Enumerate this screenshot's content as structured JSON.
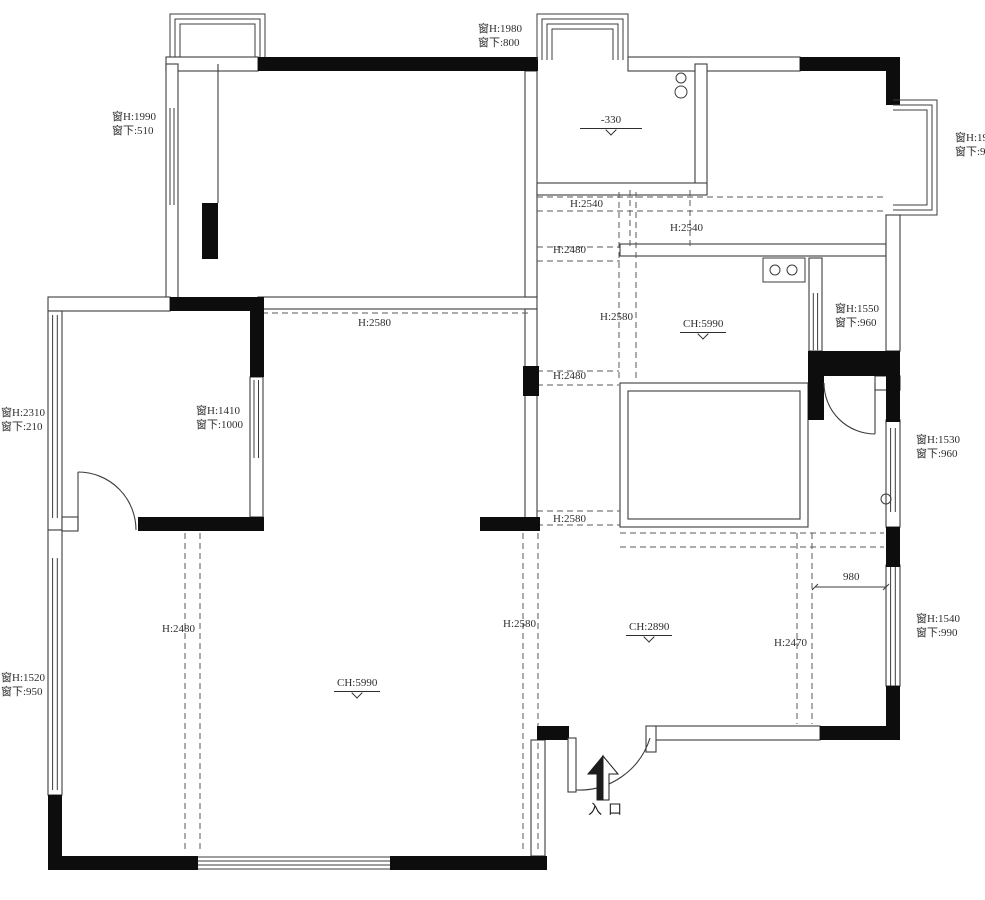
{
  "colors": {
    "structural_wall": "#0d0d0d",
    "thin_wall_line": "#3c3c3c",
    "dashed_beam_line": "#5a5a5a",
    "annotation_text": "#2e2e2e",
    "background": "#ffffff"
  },
  "entrance": {
    "text": "入口"
  },
  "labels": {
    "window_annotations": [
      {
        "id": "win-top-center",
        "line1": "窗H:1980",
        "line2": "窗下:800",
        "x": 478,
        "y": 22
      },
      {
        "id": "win-top-left",
        "line1": "窗H:1990",
        "line2": "窗下:510",
        "x": 112,
        "y": 110
      },
      {
        "id": "win-right-top",
        "line1": "窗H:19",
        "line2": "窗下:9",
        "x": 955,
        "y": 131
      },
      {
        "id": "win-right-mid1",
        "line1": "窗H:1550",
        "line2": "窗下:960",
        "x": 835,
        "y": 302
      },
      {
        "id": "win-left-mid",
        "line1": "窗H:2310",
        "line2": "窗下:210",
        "x": 1,
        "y": 406
      },
      {
        "id": "win-bedroom2",
        "line1": "窗H:1410",
        "line2": "窗下:1000",
        "x": 196,
        "y": 404
      },
      {
        "id": "win-right-mid2",
        "line1": "窗H:1530",
        "line2": "窗下:960",
        "x": 916,
        "y": 433
      },
      {
        "id": "win-right-bottom",
        "line1": "窗H:1540",
        "line2": "窗下:990",
        "x": 916,
        "y": 612
      },
      {
        "id": "win-left-bottom",
        "line1": "窗H:1520",
        "line2": "窗下:950",
        "x": 1,
        "y": 671
      }
    ],
    "beam_heights": [
      {
        "id": "beam-h2540-a",
        "text": "H:2540",
        "x": 570,
        "y": 197
      },
      {
        "id": "beam-h2540-b",
        "text": "H:2540",
        "x": 670,
        "y": 221
      },
      {
        "id": "beam-h2480-a",
        "text": "H:2480",
        "x": 553,
        "y": 243
      },
      {
        "id": "beam-h2580-a",
        "text": "H:2580",
        "x": 358,
        "y": 316
      },
      {
        "id": "beam-h2580-b",
        "text": "H:2580",
        "x": 600,
        "y": 310
      },
      {
        "id": "beam-h2480-b",
        "text": "H:2480",
        "x": 553,
        "y": 369
      },
      {
        "id": "beam-h2580-c",
        "text": "H:2580",
        "x": 553,
        "y": 512
      },
      {
        "id": "beam-h2480-c",
        "text": "H:2480",
        "x": 162,
        "y": 622
      },
      {
        "id": "beam-h2580-d",
        "text": "H:2580",
        "x": 503,
        "y": 617
      },
      {
        "id": "beam-h2470",
        "text": "H:2470",
        "x": 774,
        "y": 636
      }
    ],
    "ceiling_levels": [
      {
        "id": "ceiling-kitchen-dining",
        "text": "CH:5990",
        "x": 680,
        "y": 317
      },
      {
        "id": "ceiling-living",
        "text": "CH:5990",
        "x": 334,
        "y": 676
      },
      {
        "id": "ceiling-entry",
        "text": "CH:2890",
        "x": 626,
        "y": 620
      }
    ],
    "floor_levels": [
      {
        "id": "floor-level-kitchen",
        "text": "-330",
        "x": 580,
        "y": 113
      }
    ],
    "dimensions": [
      {
        "id": "dim-980",
        "text": "980",
        "x": 843,
        "y": 570
      }
    ]
  }
}
